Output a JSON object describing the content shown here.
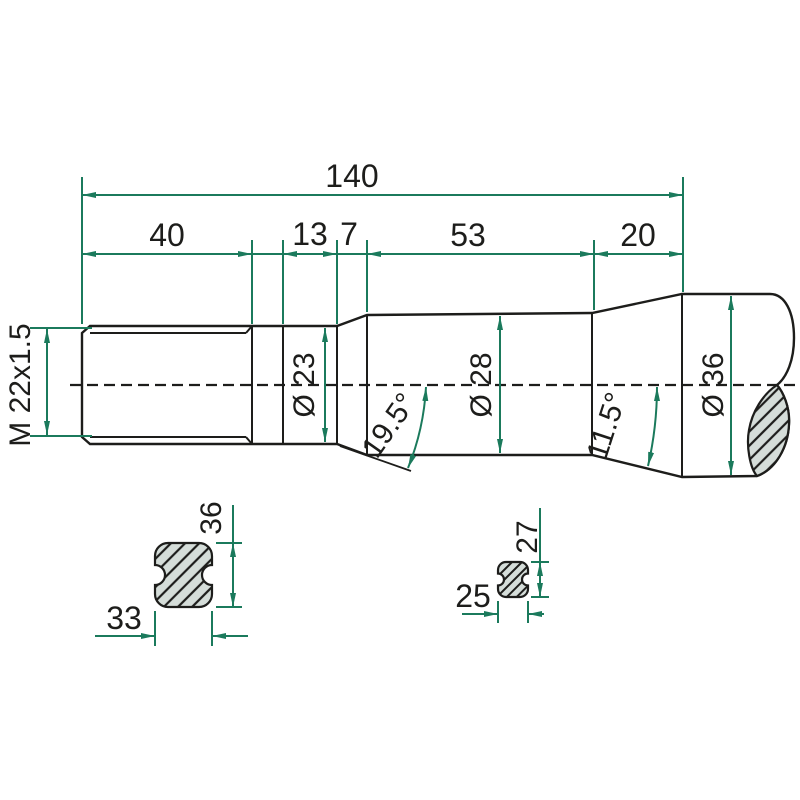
{
  "drawing": {
    "labels": {
      "length_overall": "140",
      "length_thread": "40",
      "length_neck": "13",
      "length_taper": "7",
      "length_mid": "53",
      "length_end": "20",
      "thread": "M 22x1.5",
      "dia_neck": "Ø 23",
      "dia_mid": "Ø 28",
      "dia_end": "Ø 36",
      "angle_front": "19.5°",
      "angle_rear": "11.5°"
    },
    "section_left": {
      "height": "36",
      "width": "33"
    },
    "section_right": {
      "height": "27",
      "width": "25"
    },
    "colors": {
      "body_fill": "#95b1ad",
      "dimension_green": "#1b7a5c",
      "outline": "#1d1d1b",
      "hatch_fill": "#d5ddd9",
      "background": "#ffffff"
    }
  }
}
